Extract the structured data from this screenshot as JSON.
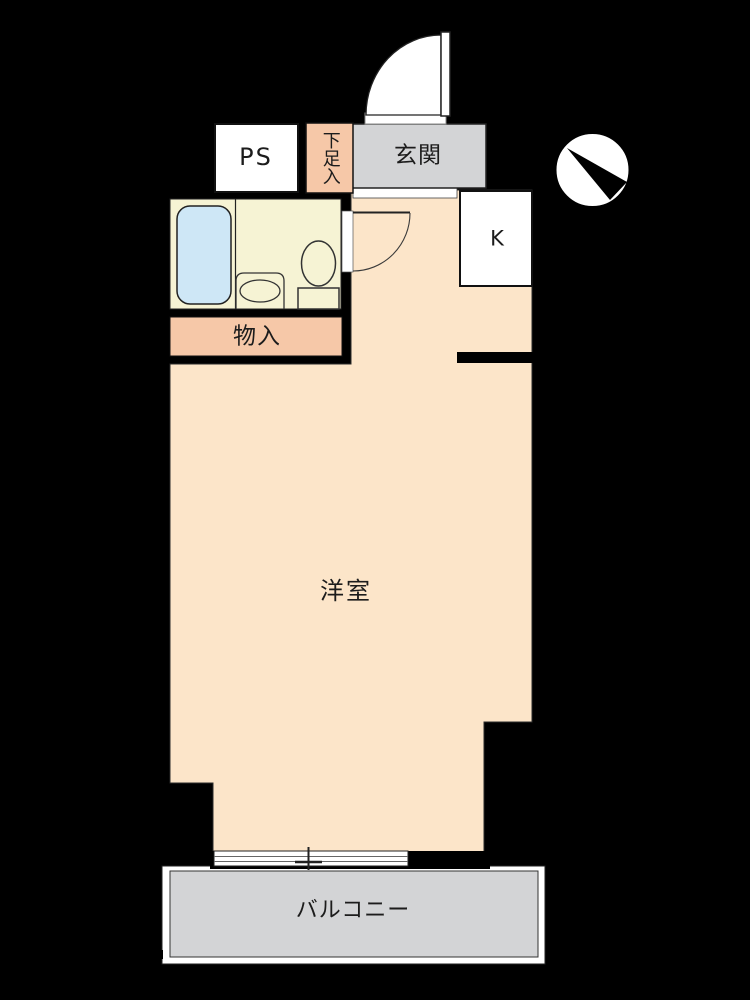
{
  "page_title": "apartment-floor-plan",
  "floor_plan": {
    "labels": {
      "ps": "PS",
      "shoe_box": "下足入",
      "entrance": "玄関",
      "kitchen": "K",
      "storage": "物入",
      "western_room": "洋室",
      "balcony": "バルコニー"
    },
    "icons": {
      "compass": "north-arrow-compass-circle",
      "bathtub": "rounded-rect-tub",
      "toilet": "oval-bowl-with-tank",
      "sink": "oval-basin",
      "entrance_door": "quarter-circle-swing",
      "bathroom_door": "quarter-circle-swing",
      "window": "double-line-sliding-window"
    }
  },
  "colors": {
    "room_peach": "#fce5c9",
    "storage_salmon": "#f6c8a8",
    "bathroom_cream": "#f6f3d4",
    "bathtub_blue": "#cee7f6",
    "entrance_gray": "#d3d4d6",
    "balcony_gray": "#d3d4d6",
    "fixture_white": "#ffffff",
    "wall_black": "#000000",
    "line_dark": "#222222"
  }
}
